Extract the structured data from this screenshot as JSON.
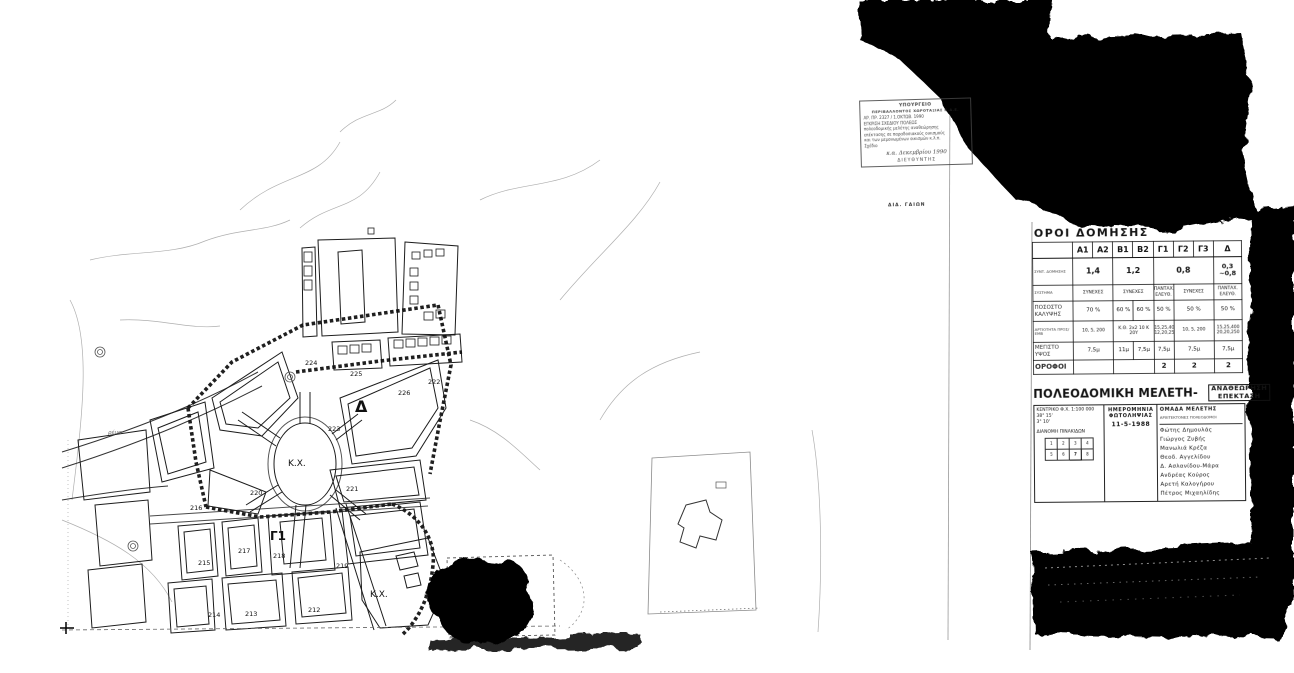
{
  "colors": {
    "ink": "#111111",
    "paper": "#ffffff",
    "toner": "#060606"
  },
  "stamp": {
    "lines": [
      "ΥΠΟΥΡΓΕΙΟ",
      "ΠΕΡΙΒΑΛΛΟΝΤΟΣ ΧΩΡΟΤΑΞΙΑΣ Κ.Δ.Ε.",
      "ΑΡ. ΠΡ. 2327 / 1.ΟΚΤΩΒ. 1990",
      "ΕΓΚΡΙΣΗ ΣΧΕΔΙΟΥ ΠΟΛΕΩΣ",
      "πολεοδομικής μελέτης αναθεώρησης",
      "επέκτασης σε παραδοσιακούς οικισμούς",
      "και των μεμονωμένων οικισμών κ.λ.π.",
      "Σχέδιο"
    ],
    "signature_date": "κ.α. Δεκεμβρίου 1990",
    "signature_title": "ΔΙΕΥΘΥΝΤΗΣ",
    "caption_below": "ΔΙΔ. ΓΑΙΩΝ"
  },
  "oroi": {
    "title": "ΟΡΟΙ ΔΟΜΗΣΗΣ",
    "columns": [
      "Α1",
      "Α2",
      "Β1",
      "Β2",
      "Γ1",
      "Γ2",
      "Γ3",
      "Δ"
    ],
    "rows": [
      {
        "label": "ΣΥΝΤ. ΔΟΜΗΣΗΣ",
        "cells": [
          "1,4",
          "1,2",
          "0,8",
          "0,3 ~0,8"
        ]
      },
      {
        "label": "ΣΥΣΤΗΜΑ",
        "cells": [
          "ΣΥΝΕΧΕΣ",
          "ΣΥΝΕΧΕΣ",
          "ΠΑΝΤΑΧ. ΕΛΕΥΘ.",
          "ΣΥΝΕΧΕΣ",
          "ΠΑΝΤΑΧ. ΕΛΕΥΘ."
        ]
      },
      {
        "label": "ΠΟΣΟΣΤΟ ΚΑΛΥΨΗΣ",
        "cells": [
          "70 %",
          "60 %",
          "60 %",
          "50 %",
          "50 %",
          "50 %"
        ]
      },
      {
        "label": "ΑΡΤΙΟΤΗΤΑ ΠΡΟΣ/ΕΜΒ",
        "cells": [
          "10, 5, 200",
          "Κ.Θ. 2x2 10 Κ 20Υ",
          "15,25,400 12,20,250",
          "10, 5, 200",
          "15,25,400 20,20,250"
        ]
      },
      {
        "label": "ΜΕΓΙΣΤΟ ΥΨΟΣ",
        "cells": [
          "7,5μ",
          "11μ",
          "7,5μ",
          "7,5μ",
          "7,5μ",
          "7,5μ"
        ]
      },
      {
        "label": "ΟΡΟΦΟΙ",
        "cells": [
          "",
          "",
          "2",
          "2",
          "2"
        ]
      }
    ]
  },
  "title_block": {
    "title_main": "ΠΟΛΕΟΔΟΜΙΚΗ ΜΕΛΕΤΗ-",
    "badge1": "ΑΝΑΘΕΩΡΗΣΗ",
    "badge2": "ΕΠΕΚΤΑΣΗ",
    "left": {
      "line1": "ΚΕΝΤΡΙΚΟ Φ.Χ. 1:100 000",
      "line2": "38° 15'",
      "line3": "3° 10'",
      "line4": "ΔΙΑΝΟΜΗ ΠΙΝΑΚΙΔΩΝ",
      "grid": [
        "1",
        "2",
        "3",
        "4",
        "5",
        "6",
        "7",
        "8"
      ]
    },
    "middle": {
      "line1": "ΗΜΕΡΟΜΗΝΙΑ",
      "line2": "ΦΩΤΟΛΗΨΙΑΣ",
      "date": "11-5-1988"
    },
    "team": {
      "heading": "ΟΜΑΔΑ ΜΕΛΕΤΗΣ",
      "subheading": "ΑΡΧΙΤΕΚΤΟΝΕΣ ΠΟΛΕΟΔΟΜΟΙ",
      "members": [
        "Φώτης Δημουλάς",
        "Γιώργος Ζυβής",
        "Μανωλιά Κρέζα",
        "Θεοδ. Αγγελίδου",
        "Δ. Ασλανίδου-Μάρα",
        "Ανδρέας Κούρος",
        "Αρετή Καλογήρου",
        "Πέτρος Μιχαηλίδης"
      ]
    }
  },
  "map": {
    "labels": [
      {
        "text": "Δ"
      },
      {
        "text": "Κ.Χ."
      },
      {
        "text": "Γ1"
      },
      {
        "text": "Κ.Χ."
      },
      {
        "text": "225"
      },
      {
        "text": "226"
      },
      {
        "text": "223"
      },
      {
        "text": "221"
      },
      {
        "text": "220"
      },
      {
        "text": "224"
      },
      {
        "text": "216"
      },
      {
        "text": "217"
      },
      {
        "text": "215"
      },
      {
        "text": "218"
      },
      {
        "text": "219"
      },
      {
        "text": "214"
      },
      {
        "text": "213"
      },
      {
        "text": "212"
      },
      {
        "text": "222"
      },
      {
        "text": "ρέμα"
      }
    ]
  }
}
